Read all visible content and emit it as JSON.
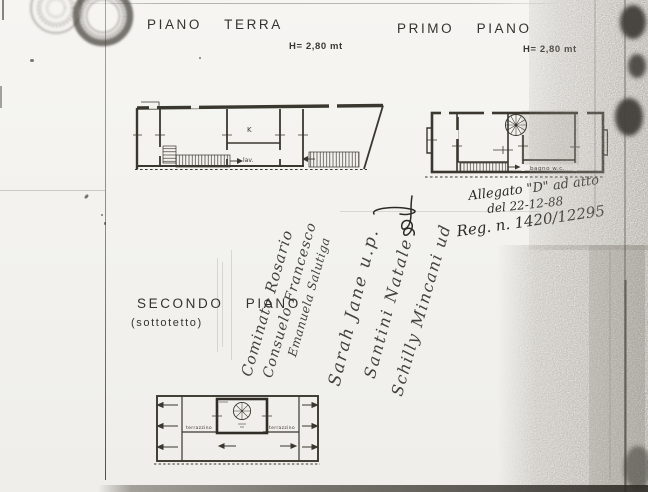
{
  "page": {
    "document_type_note": "scanned floor-plan sheet",
    "floors": [
      {
        "id": "terra",
        "title": "PIANO TERRA",
        "height_label": "H= 2,80 mt",
        "rooms": {
          "kitchen": "K",
          "laundry": "lav."
        }
      },
      {
        "id": "primo",
        "title": "PRIMO PIANO",
        "height_label": "H= 2,80 mt",
        "rooms": {
          "bath": "bagno  w.c."
        }
      },
      {
        "id": "secondo",
        "title": "SECONDO PIANO",
        "subtitle": "(sottotetto)",
        "rooms": {
          "terrace_left": "terrazzino",
          "terrace_right": "terrazzino"
        }
      }
    ],
    "annotation": {
      "line1": "Allegato \"D\" ad atto",
      "line2": "del 22-12-88",
      "line3": "Reg. n. 1420/12295"
    },
    "signatures": [
      "Cominato Rosario",
      "Consuelo Francesco",
      "Emanuela Salutiga",
      "Sarah Jane u.p.",
      "Santini Natale",
      "Schilly Mincani ud"
    ],
    "colors": {
      "paper": "#f3f2ee",
      "plan_ink": "#3a372f",
      "hand_ink": "#2c2a25",
      "stamp": "#5c584e",
      "scan_noise": "#383530"
    }
  }
}
